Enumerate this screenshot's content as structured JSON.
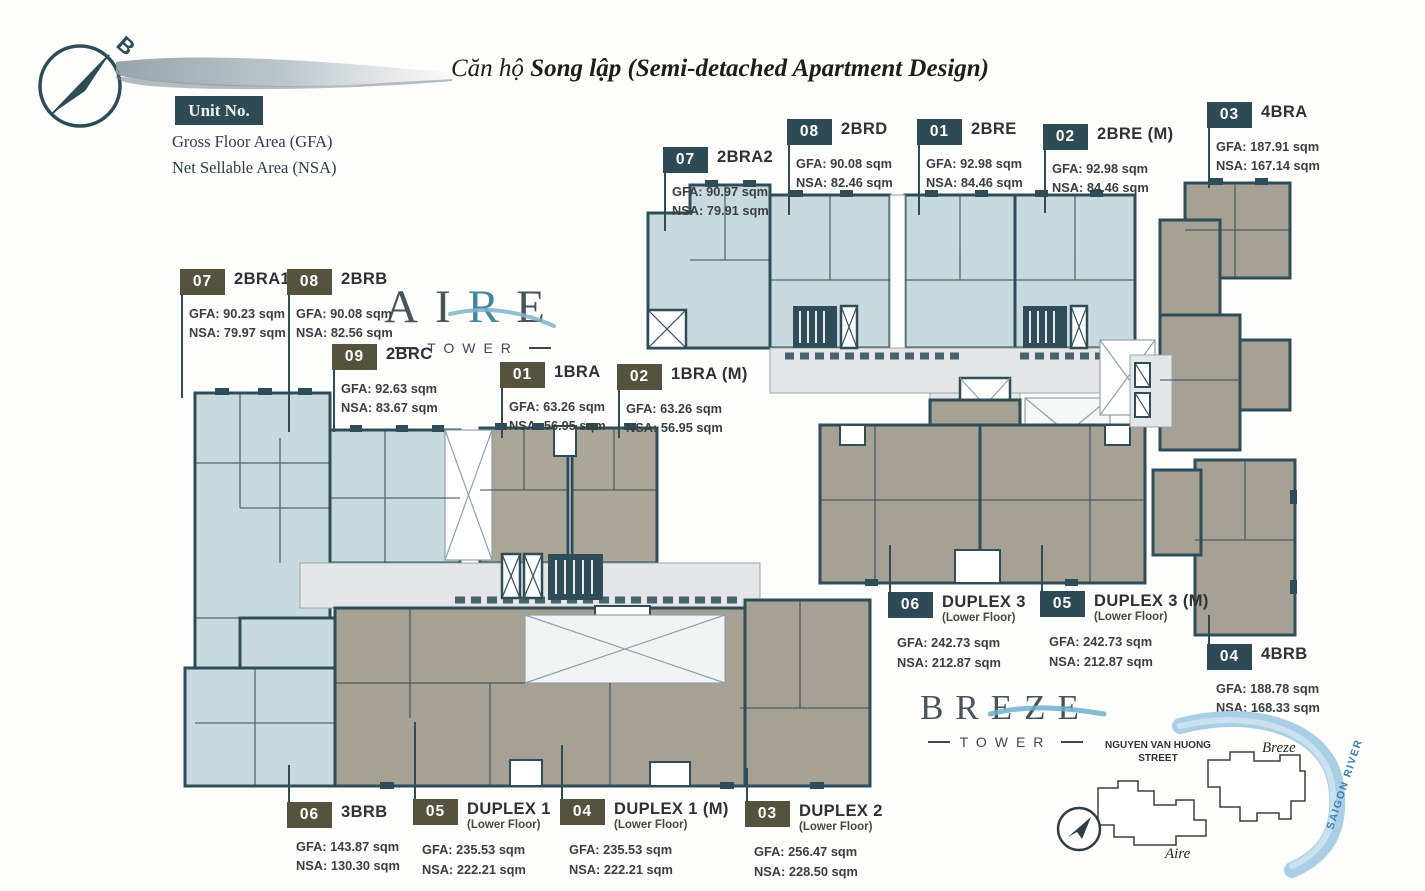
{
  "header": {
    "title_prefix": "Căn hộ",
    "title_main": "Song lập (Semi-detached Apartment Design)",
    "compass_letter": "B"
  },
  "legend": {
    "unit_no": "Unit No.",
    "gfa": "Gross Floor Area (GFA)",
    "nsa": "Net Sellable Area (NSA)"
  },
  "towers": {
    "aire": {
      "part1": "AI",
      "accent": "R",
      "part2": "E",
      "subtitle": "TOWER"
    },
    "breze": {
      "part1": "BRE",
      "accent": "Z",
      "part2": "E",
      "subtitle": "TOWER"
    }
  },
  "units": [
    {
      "no": "07",
      "label": "2BRA2",
      "gfa": "GFA: 90.97 sqm",
      "nsa": "NSA: 79.91 sqm"
    },
    {
      "no": "08",
      "label": "2BRD",
      "gfa": "GFA: 90.08 sqm",
      "nsa": "NSA: 82.46 sqm"
    },
    {
      "no": "01",
      "label": "2BRE",
      "gfa": "GFA: 92.98 sqm",
      "nsa": "NSA: 84.46 sqm"
    },
    {
      "no": "02",
      "label": "2BRE (M)",
      "gfa": "GFA: 92.98 sqm",
      "nsa": "NSA: 84.46 sqm"
    },
    {
      "no": "03",
      "label": "4BRA",
      "gfa": "GFA: 187.91 sqm",
      "nsa": "NSA: 167.14 sqm"
    },
    {
      "no": "07",
      "label": "2BRA1",
      "gfa": "GFA: 90.23 sqm",
      "nsa": "NSA: 79.97 sqm"
    },
    {
      "no": "08",
      "label": "2BRB",
      "gfa": "GFA: 90.08 sqm",
      "nsa": "NSA: 82.56 sqm"
    },
    {
      "no": "09",
      "label": "2BRC",
      "gfa": "GFA: 92.63 sqm",
      "nsa": "NSA: 83.67 sqm"
    },
    {
      "no": "01",
      "label": "1BRA",
      "gfa": "GFA: 63.26 sqm",
      "nsa": "NSA: 56.95 sqm"
    },
    {
      "no": "02",
      "label": "1BRA (M)",
      "gfa": "GFA: 63.26 sqm",
      "nsa": "NSA: 56.95 sqm"
    },
    {
      "no": "06",
      "label": "DUPLEX 3",
      "sub": "(Lower Floor)",
      "gfa": "GFA: 242.73 sqm",
      "nsa": "NSA: 212.87 sqm"
    },
    {
      "no": "05",
      "label": "DUPLEX 3 (M)",
      "sub": "(Lower Floor)",
      "gfa": "GFA: 242.73 sqm",
      "nsa": "NSA: 212.87 sqm"
    },
    {
      "no": "04",
      "label": "4BRB",
      "gfa": "GFA: 188.78 sqm",
      "nsa": "NSA: 168.33 sqm"
    },
    {
      "no": "06",
      "label": "3BRB",
      "gfa": "GFA: 143.87 sqm",
      "nsa": "NSA: 130.30 sqm"
    },
    {
      "no": "05",
      "label": "DUPLEX 1",
      "sub": "(Lower Floor)",
      "gfa": "GFA: 235.53 sqm",
      "nsa": "NSA: 222.21 sqm"
    },
    {
      "no": "04",
      "label": "DUPLEX 1 (M)",
      "sub": "(Lower Floor)",
      "gfa": "GFA: 235.53 sqm",
      "nsa": "NSA: 222.21 sqm"
    },
    {
      "no": "03",
      "label": "DUPLEX 2",
      "sub": "(Lower Floor)",
      "gfa": "GFA: 256.47 sqm",
      "nsa": "NSA: 228.50 sqm"
    }
  ],
  "minimap": {
    "street_line1": "NGUYEN VAN HUONG",
    "street_line2": "STREET",
    "breze_label": "Breze",
    "aire_label": "Aire",
    "river_label": "SAIGON RIVER"
  },
  "colors": {
    "wall": "#2f4d58",
    "unit_blue": "#c9dade",
    "unit_taupe": "#a6a095",
    "corridor": "#e4e6e7",
    "chip_teal": "#2e4a54",
    "chip_olive": "#55523e",
    "accent_blue": "#4387a3",
    "river_blue": "#aacfe4"
  }
}
